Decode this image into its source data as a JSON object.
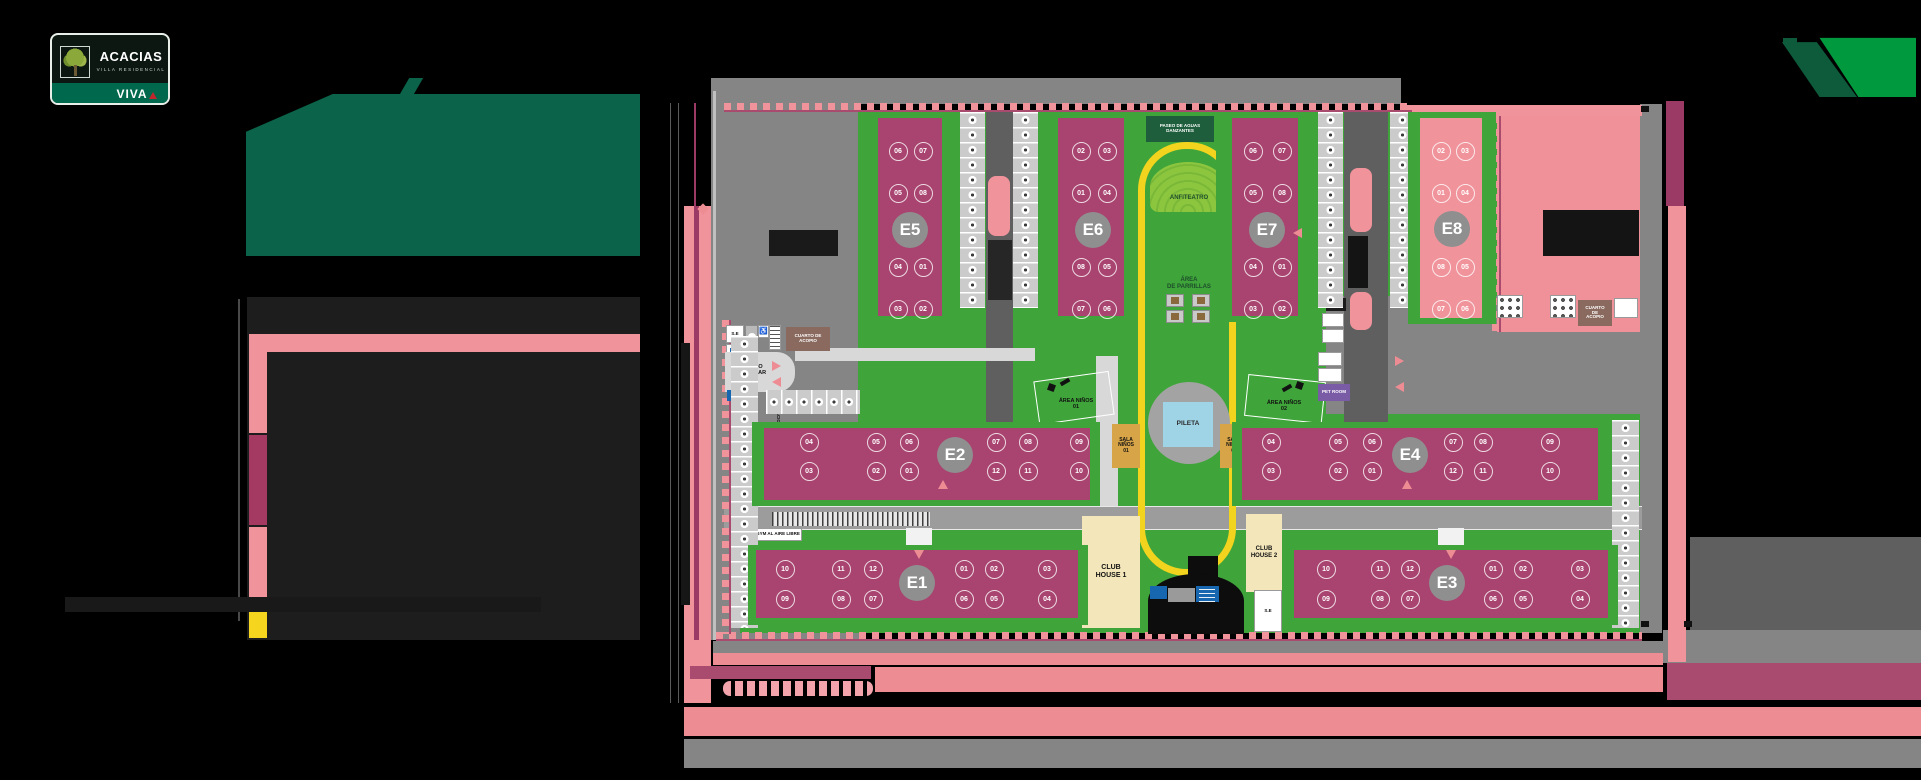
{
  "brand": {
    "name": "ACACIAS",
    "tagline": "VILLA RESIDENCIAL",
    "badge": "VIVA"
  },
  "colors": {
    "building_magenta": "#a8446f",
    "building_pink": "#f0939b",
    "lawn_green": "#3fa53a",
    "brand_dark_green": "#0b6349",
    "brand_bright_green": "#00993e",
    "track_yellow": "#f2d31d",
    "pool_blue": "#9fd3e6",
    "street_gray": "#858585",
    "accent_magenta": "#a84b6e",
    "accent_salmon": "#ee8c94",
    "legend_yellow": "#f5d51e",
    "pet_room_purple": "#7a5ca6",
    "acopio_brown": "#8a6a5e"
  },
  "map": {
    "amenities": {
      "paseo_sign": "PASEO DE AGUAS\nDANZANTES",
      "anfiteatro": "ANFITEATRO",
      "parrillas": "ÁREA\nDE PARRILLAS",
      "pileta": "PILETA",
      "sala_ninos_1": "SALA\nNIÑOS\n01",
      "sala_ninos_2": "SALA\nNIÑOS\n02",
      "area_ninos_1": "ÁREA NIÑOS\n01",
      "area_ninos_2": "ÁREA NIÑOS\n02",
      "pet_room": "PET ROOM",
      "club_house_1": "CLUB\nHOUSE 1",
      "club_house_2": "CLUB\nHOUSE 2",
      "cuarto_acopio_left": "CUARTO DE\nACOPIO",
      "cuarto_acopio_right": "CUARTO\nDE\nACOPIO",
      "ingreso_vehicular": "INGRESO\nVEHICULAR",
      "gym": "GYM AL AIRE LIBRE",
      "estacionamiento": "ESTACIONAMIENTO",
      "se_top": "S.E",
      "se_bottom": "S.E"
    },
    "buildings": [
      {
        "id": "E5",
        "type": "magenta",
        "zone": [
          862,
          112,
          96,
          210
        ],
        "slab": [
          878,
          118,
          64,
          198
        ],
        "label": [
          910,
          230
        ],
        "units": [
          [
            "06",
            897,
            150
          ],
          [
            "07",
            922,
            150
          ],
          [
            "05",
            897,
            192
          ],
          [
            "08",
            922,
            192
          ],
          [
            "04",
            897,
            266
          ],
          [
            "01",
            922,
            266
          ],
          [
            "03",
            897,
            308
          ],
          [
            "02",
            922,
            308
          ]
        ]
      },
      {
        "id": "E6",
        "type": "magenta",
        "zone": [
          1042,
          112,
          92,
          210
        ],
        "slab": [
          1058,
          118,
          66,
          198
        ],
        "label": [
          1093,
          230
        ],
        "units": [
          [
            "02",
            1080,
            150
          ],
          [
            "03",
            1106,
            150
          ],
          [
            "01",
            1080,
            192
          ],
          [
            "04",
            1106,
            192
          ],
          [
            "08",
            1080,
            266
          ],
          [
            "05",
            1106,
            266
          ],
          [
            "07",
            1080,
            308
          ],
          [
            "06",
            1106,
            308
          ]
        ]
      },
      {
        "id": "E7",
        "type": "magenta",
        "zone": [
          1216,
          112,
          94,
          210
        ],
        "slab": [
          1232,
          118,
          66,
          198
        ],
        "label": [
          1267,
          230
        ],
        "units": [
          [
            "06",
            1252,
            150
          ],
          [
            "07",
            1281,
            150
          ],
          [
            "05",
            1252,
            192
          ],
          [
            "08",
            1281,
            192
          ],
          [
            "04",
            1252,
            266
          ],
          [
            "01",
            1281,
            266
          ],
          [
            "03",
            1252,
            308
          ],
          [
            "02",
            1281,
            308
          ]
        ]
      },
      {
        "id": "E8",
        "type": "pink",
        "zone": [
          1408,
          112,
          88,
          212
        ],
        "slab": [
          1420,
          118,
          62,
          200
        ],
        "label": [
          1452,
          229
        ],
        "units": [
          [
            "02",
            1440,
            150
          ],
          [
            "03",
            1464,
            150
          ],
          [
            "01",
            1440,
            192
          ],
          [
            "04",
            1464,
            192
          ],
          [
            "08",
            1440,
            266
          ],
          [
            "05",
            1464,
            266
          ],
          [
            "07",
            1440,
            308
          ],
          [
            "06",
            1464,
            308
          ]
        ]
      },
      {
        "id": "E2",
        "type": "magenta",
        "zone": [
          752,
          422,
          348,
          84
        ],
        "slab": [
          764,
          428,
          326,
          72
        ],
        "label": [
          955,
          455
        ],
        "units": [
          [
            "04",
            808,
            441
          ],
          [
            "05",
            875,
            441
          ],
          [
            "06",
            908,
            441
          ],
          [
            "07",
            995,
            441
          ],
          [
            "08",
            1027,
            441
          ],
          [
            "09",
            1078,
            441
          ],
          [
            "03",
            808,
            470
          ],
          [
            "02",
            875,
            470
          ],
          [
            "01",
            908,
            470
          ],
          [
            "12",
            995,
            470
          ],
          [
            "11",
            1027,
            470
          ],
          [
            "10",
            1078,
            470
          ]
        ]
      },
      {
        "id": "E4",
        "type": "magenta",
        "zone": [
          1232,
          422,
          378,
          84
        ],
        "slab": [
          1242,
          428,
          356,
          72
        ],
        "label": [
          1410,
          455
        ],
        "units": [
          [
            "04",
            1270,
            441
          ],
          [
            "05",
            1337,
            441
          ],
          [
            "06",
            1371,
            441
          ],
          [
            "07",
            1452,
            441
          ],
          [
            "08",
            1482,
            441
          ],
          [
            "09",
            1549,
            441
          ],
          [
            "03",
            1270,
            470
          ],
          [
            "02",
            1337,
            470
          ],
          [
            "01",
            1371,
            470
          ],
          [
            "12",
            1452,
            470
          ],
          [
            "11",
            1482,
            470
          ],
          [
            "10",
            1549,
            470
          ]
        ]
      },
      {
        "id": "E1",
        "type": "magenta",
        "zone": [
          748,
          545,
          340,
          80
        ],
        "slab": [
          756,
          550,
          322,
          68
        ],
        "label": [
          917,
          583
        ],
        "units": [
          [
            "10",
            784,
            568
          ],
          [
            "11",
            840,
            568
          ],
          [
            "12",
            872,
            568
          ],
          [
            "01",
            963,
            568
          ],
          [
            "02",
            993,
            568
          ],
          [
            "03",
            1046,
            568
          ],
          [
            "09",
            784,
            598
          ],
          [
            "08",
            840,
            598
          ],
          [
            "07",
            872,
            598
          ],
          [
            "06",
            963,
            598
          ],
          [
            "05",
            993,
            598
          ],
          [
            "04",
            1046,
            598
          ]
        ]
      },
      {
        "id": "E3",
        "type": "magenta",
        "zone": [
          1288,
          545,
          330,
          80
        ],
        "slab": [
          1294,
          550,
          314,
          68
        ],
        "label": [
          1447,
          583
        ],
        "units": [
          [
            "10",
            1325,
            568
          ],
          [
            "11",
            1379,
            568
          ],
          [
            "12",
            1409,
            568
          ],
          [
            "01",
            1492,
            568
          ],
          [
            "02",
            1522,
            568
          ],
          [
            "03",
            1579,
            568
          ],
          [
            "09",
            1325,
            598
          ],
          [
            "08",
            1379,
            598
          ],
          [
            "07",
            1409,
            598
          ],
          [
            "06",
            1492,
            598
          ],
          [
            "05",
            1522,
            598
          ],
          [
            "04",
            1579,
            598
          ]
        ]
      }
    ],
    "parking": [
      {
        "x": 960,
        "y": 112,
        "w": 25,
        "h": 196,
        "dir": "v"
      },
      {
        "x": 1013,
        "y": 112,
        "w": 25,
        "h": 196,
        "dir": "v"
      },
      {
        "x": 1318,
        "y": 112,
        "w": 25,
        "h": 196,
        "dir": "v"
      },
      {
        "x": 1390,
        "y": 112,
        "w": 25,
        "h": 196,
        "dir": "v"
      },
      {
        "x": 731,
        "y": 336,
        "w": 27,
        "h": 292,
        "dir": "v"
      },
      {
        "x": 1612,
        "y": 420,
        "w": 27,
        "h": 208,
        "dir": "v"
      },
      {
        "x": 766,
        "y": 390,
        "w": 94,
        "h": 24,
        "dir": "h"
      }
    ],
    "arrows": [
      {
        "x": 772,
        "y": 361,
        "dir": "r"
      },
      {
        "x": 772,
        "y": 377,
        "dir": "l"
      },
      {
        "x": 914,
        "y": 550,
        "dir": "d"
      },
      {
        "x": 1446,
        "y": 550,
        "dir": "d"
      },
      {
        "x": 938,
        "y": 480,
        "dir": "u"
      },
      {
        "x": 1402,
        "y": 480,
        "dir": "u"
      },
      {
        "x": 1395,
        "y": 356,
        "dir": "r"
      },
      {
        "x": 1395,
        "y": 382,
        "dir": "l"
      },
      {
        "x": 1293,
        "y": 228,
        "dir": "l"
      }
    ]
  }
}
